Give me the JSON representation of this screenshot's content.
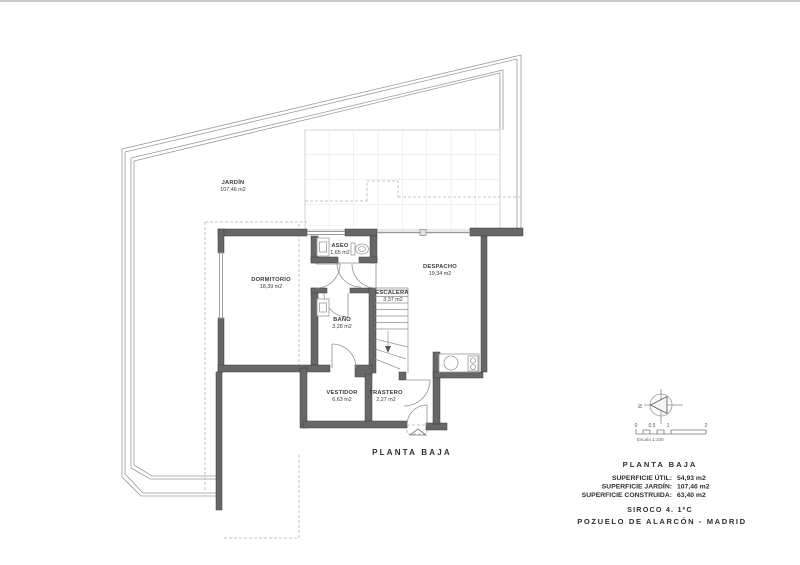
{
  "plan": {
    "title": "PLANTA BAJA",
    "rooms": [
      {
        "name": "JARDÍN",
        "area": "107,46 m2"
      },
      {
        "name": "DORMITORIO",
        "area": "18,39 m2"
      },
      {
        "name": "ASEO",
        "area": "1,65 m2"
      },
      {
        "name": "DESPACHO",
        "area": "19,34 m2"
      },
      {
        "name": "ESCALERA",
        "area": "3,37 m2"
      },
      {
        "name": "BAÑO",
        "area": "3,28 m2"
      },
      {
        "name": "VESTIDOR",
        "area": "6,63 m2"
      },
      {
        "name": "TRASTERO",
        "area": "2,27 m2"
      }
    ]
  },
  "legend": {
    "north_label": "N",
    "scale": {
      "ticks": [
        "0",
        "0,5",
        "1",
        "2"
      ],
      "caption": "Escala 1:100"
    }
  },
  "info": {
    "title": "PLANTA BAJA",
    "lines": [
      {
        "label": "SUPERFICIE ÚTIL:",
        "value": "54,93 m2"
      },
      {
        "label": "SUPERFICIE JARDÍN:",
        "value": "107,46 m2"
      },
      {
        "label": "SUPERFICIE CONSTRUIDA:",
        "value": "63,40 m2"
      }
    ],
    "project": "SIROCO 4. 1ºC",
    "location": "POZUELO DE ALARCÓN - MADRID"
  },
  "colors": {
    "wall": "#676767",
    "wall_outline": "#3d3d3d",
    "boundary_line": "#9a9a9a",
    "tile_line": "#d6d6d6",
    "text": "#3b3b3b"
  }
}
